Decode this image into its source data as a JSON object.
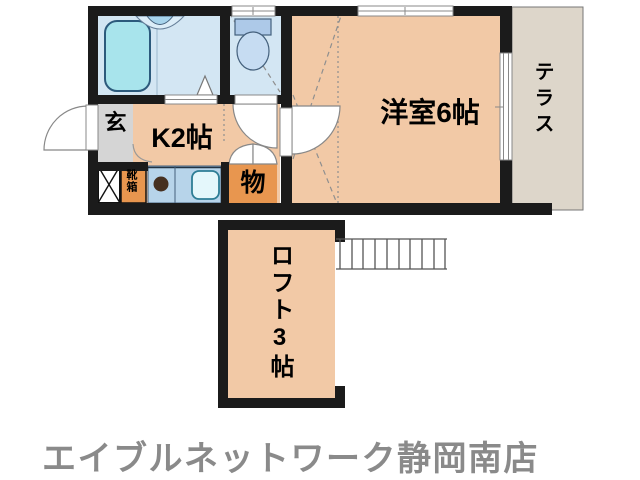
{
  "colors": {
    "wall": "#1b1b1b",
    "room_floor": "#f2c9a6",
    "wet_area_floor": "#d3e6f3",
    "bathtub": "#a8e4ec",
    "counter_blue": "#b7d4ea",
    "sink_white": "#e4f7fb",
    "closet_orange": "#e8964f",
    "entrance_gray": "#d5d5d5",
    "terrace_beige": "#ddd6ca",
    "dash_gray": "#8f8f8f",
    "brand_gray": "#8a8a8a"
  },
  "floorplan": {
    "labels": {
      "entrance": "玄",
      "kitchen": "K2帖",
      "storage": "物",
      "shoe_cabinet": "靴箱",
      "western_room": "洋室6帖",
      "terrace": "テラス",
      "loft": "ロフト3帖"
    },
    "icons": [
      "bathtub",
      "washbasin",
      "toilet",
      "kitchen-sink",
      "stove-burner",
      "meter-box",
      "ladder",
      "door-swing",
      "folding-door",
      "window"
    ]
  },
  "footer": {
    "brand": "エイブルネットワーク静岡南店"
  }
}
